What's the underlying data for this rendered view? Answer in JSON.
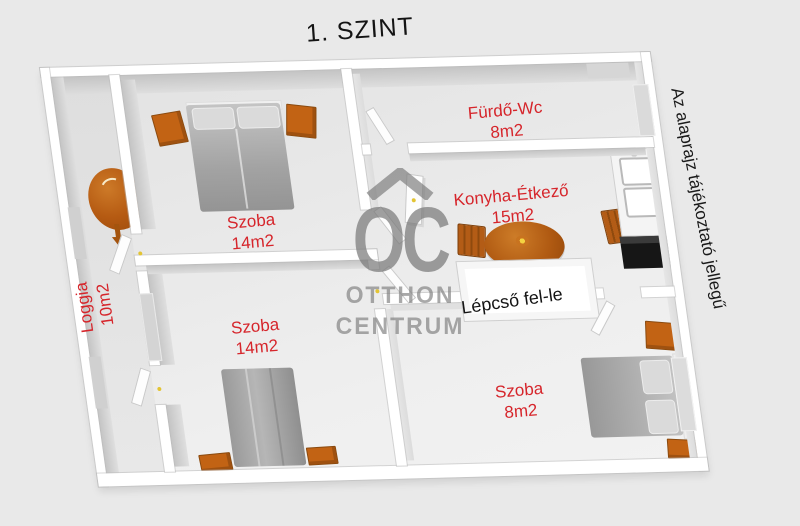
{
  "title": "1. SZINT",
  "disclaimer": "Az alaprajz tájékoztató jellegű",
  "watermark": {
    "monogram": "OC",
    "line1": "OTTHON",
    "line2": "CENTRUM"
  },
  "rooms": [
    {
      "name": "Szoba",
      "area": "14m2"
    },
    {
      "name": "Fürdő-Wc",
      "area": "8m2"
    },
    {
      "name": "Konyha-Étkező",
      "area": "15m2"
    },
    {
      "name": "Szoba",
      "area": "14m2"
    },
    {
      "name": "Szoba",
      "area": "8m2"
    },
    {
      "name": "Loggia",
      "area": "10m2"
    }
  ],
  "stairs_label": "Lépcső fel-le",
  "colors": {
    "label_red": "#d6252b",
    "furniture_orange": "#c26314",
    "watermark_gray": "#9f9f9f",
    "background": "#e9e9e9",
    "wall_white": "#ffffff"
  }
}
